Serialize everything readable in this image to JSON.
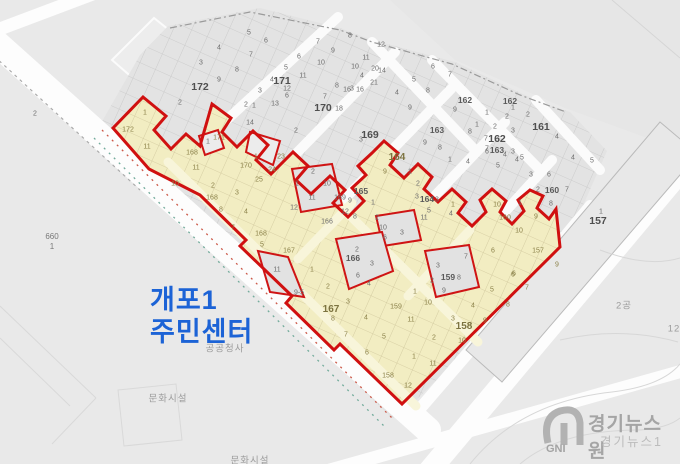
{
  "map": {
    "region_title": {
      "line1": "개포1",
      "line2": "주민센터"
    },
    "colors": {
      "background": "#e9e9e9",
      "parcel_gray": "#e4e4e4",
      "highlight_fill": "#f2edc2",
      "highlight_street": "#f7f3d6",
      "boundary_red": "#d01010",
      "title_blue": "#1c63d6",
      "road_white": "#fdfdfd"
    },
    "labels": [
      [
        "5",
        249,
        33,
        "n"
      ],
      [
        "4",
        219,
        48,
        "n"
      ],
      [
        "3",
        201,
        63,
        "n"
      ],
      [
        "7",
        251,
        55,
        "n"
      ],
      [
        "6",
        266,
        41,
        "n"
      ],
      [
        "8",
        237,
        70,
        "n"
      ],
      [
        "9",
        219,
        80,
        "n"
      ],
      [
        "172",
        200,
        87,
        "b"
      ],
      [
        "2",
        180,
        103,
        "n"
      ],
      [
        "2",
        35,
        114,
        "n"
      ],
      [
        "8",
        350,
        36,
        "n"
      ],
      [
        "7",
        318,
        42,
        "n"
      ],
      [
        "6",
        299,
        57,
        "n"
      ],
      [
        "5",
        286,
        68,
        "n"
      ],
      [
        "9",
        333,
        51,
        "n"
      ],
      [
        "10",
        321,
        63,
        "n"
      ],
      [
        "11",
        303,
        76,
        "n"
      ],
      [
        "4",
        272,
        80,
        "n"
      ],
      [
        "171",
        282,
        81,
        "b"
      ],
      [
        "12",
        287,
        89,
        "n"
      ],
      [
        "3",
        260,
        91,
        "n"
      ],
      [
        "13",
        275,
        104,
        "n"
      ],
      [
        "2",
        246,
        105,
        "n"
      ],
      [
        "1",
        254,
        106,
        "n"
      ],
      [
        "14",
        250,
        123,
        "n"
      ],
      [
        "2",
        296,
        131,
        "n"
      ],
      [
        "12",
        381,
        45,
        "n"
      ],
      [
        "11",
        366,
        58,
        "n"
      ],
      [
        "10",
        355,
        67,
        "n"
      ],
      [
        "14",
        382,
        71,
        "n"
      ],
      [
        "8",
        337,
        86,
        "n"
      ],
      [
        "16",
        360,
        90,
        "n"
      ],
      [
        "7",
        325,
        97,
        "n"
      ],
      [
        "170",
        323,
        108,
        "b"
      ],
      [
        "18",
        339,
        109,
        "n"
      ],
      [
        "4",
        362,
        76,
        "n"
      ],
      [
        "3",
        352,
        89,
        "n"
      ],
      [
        "20",
        375,
        69,
        "n"
      ],
      [
        "21",
        374,
        83,
        "n"
      ],
      [
        "6",
        287,
        96,
        "n"
      ],
      [
        "169",
        370,
        135,
        "b"
      ],
      [
        "3",
        361,
        140,
        "n"
      ],
      [
        "16",
        347,
        90,
        "n"
      ],
      [
        "4",
        397,
        93,
        "n"
      ],
      [
        "8",
        428,
        91,
        "n"
      ],
      [
        "9",
        410,
        108,
        "n"
      ],
      [
        "6",
        433,
        67,
        "n"
      ],
      [
        "7",
        450,
        75,
        "n"
      ],
      [
        "5",
        414,
        80,
        "n"
      ],
      [
        "172",
        128,
        130,
        "y"
      ],
      [
        "1",
        145,
        113,
        "y"
      ],
      [
        "11",
        147,
        147,
        "y"
      ],
      [
        "11",
        196,
        168,
        "y"
      ],
      [
        "1",
        208,
        142,
        "n"
      ],
      [
        "168",
        192,
        153,
        "y"
      ],
      [
        "171",
        219,
        138,
        "y"
      ],
      [
        "10",
        175,
        184,
        "y"
      ],
      [
        "2",
        213,
        186,
        "y"
      ],
      [
        "168",
        212,
        198,
        "y"
      ],
      [
        "3",
        237,
        193,
        "y"
      ],
      [
        "8",
        221,
        210,
        "y"
      ],
      [
        "4",
        246,
        212,
        "y"
      ],
      [
        "7",
        233,
        228,
        "y"
      ],
      [
        "168",
        261,
        234,
        "y"
      ],
      [
        "5",
        262,
        245,
        "y"
      ],
      [
        "1",
        256,
        157,
        "y"
      ],
      [
        "23",
        281,
        157,
        "y"
      ],
      [
        "170",
        246,
        166,
        "y"
      ],
      [
        "24",
        272,
        170,
        "y"
      ],
      [
        "25",
        259,
        180,
        "y"
      ],
      [
        "2",
        313,
        172,
        "n"
      ],
      [
        "1",
        297,
        184,
        "n"
      ],
      [
        "10",
        327,
        184,
        "n"
      ],
      [
        "11",
        312,
        198,
        "n"
      ],
      [
        "12",
        294,
        208,
        "n"
      ],
      [
        "169",
        340,
        198,
        "n"
      ],
      [
        "166",
        327,
        222,
        "n"
      ],
      [
        "12",
        345,
        212,
        "n"
      ],
      [
        "11",
        424,
        218,
        "n"
      ],
      [
        "165",
        361,
        191,
        "s"
      ],
      [
        "9",
        350,
        201,
        "n"
      ],
      [
        "1",
        373,
        203,
        "n"
      ],
      [
        "8",
        355,
        217,
        "n"
      ],
      [
        "2",
        377,
        218,
        "n"
      ],
      [
        "10",
        383,
        228,
        "n"
      ],
      [
        "3",
        402,
        233,
        "n"
      ],
      [
        "6",
        385,
        238,
        "n"
      ],
      [
        "166",
        353,
        258,
        "s"
      ],
      [
        "2",
        357,
        250,
        "n"
      ],
      [
        "3",
        372,
        264,
        "n"
      ],
      [
        "6",
        358,
        276,
        "n"
      ],
      [
        "4",
        369,
        284,
        "n"
      ],
      [
        "164",
        397,
        158,
        "Y"
      ],
      [
        "9",
        385,
        172,
        "y"
      ],
      [
        "1",
        410,
        172,
        "n"
      ],
      [
        "2",
        418,
        184,
        "n"
      ],
      [
        "3",
        417,
        197,
        "n"
      ],
      [
        "164",
        427,
        199,
        "s"
      ],
      [
        "3",
        437,
        200,
        "n"
      ],
      [
        "5",
        429,
        211,
        "n"
      ],
      [
        "4",
        451,
        214,
        "n"
      ],
      [
        "159",
        448,
        277,
        "s"
      ],
      [
        "8",
        459,
        278,
        "n"
      ],
      [
        "3",
        438,
        266,
        "n"
      ],
      [
        "2",
        432,
        281,
        "n"
      ],
      [
        "9",
        444,
        291,
        "n"
      ],
      [
        "7",
        466,
        257,
        "n"
      ],
      [
        "163",
        437,
        130,
        "s"
      ],
      [
        "9",
        425,
        143,
        "n"
      ],
      [
        "8",
        440,
        148,
        "n"
      ],
      [
        "1",
        450,
        160,
        "n"
      ],
      [
        "9",
        455,
        110,
        "n"
      ],
      [
        "7",
        487,
        149,
        "n"
      ],
      [
        "163",
        497,
        150,
        "s"
      ],
      [
        "3",
        513,
        152,
        "n"
      ],
      [
        "4",
        468,
        162,
        "n"
      ],
      [
        "5",
        498,
        166,
        "n"
      ],
      [
        "162",
        465,
        100,
        "s"
      ],
      [
        "162",
        510,
        101,
        "s"
      ],
      [
        "7",
        486,
        139,
        "n"
      ],
      [
        "162",
        497,
        139,
        "b"
      ],
      [
        "1",
        487,
        113,
        "n"
      ],
      [
        "2",
        507,
        117,
        "n"
      ],
      [
        "8",
        470,
        132,
        "n"
      ],
      [
        "2",
        495,
        127,
        "n"
      ],
      [
        "3",
        513,
        131,
        "n"
      ],
      [
        "1",
        477,
        125,
        "n"
      ],
      [
        "6",
        487,
        152,
        "n"
      ],
      [
        "4",
        505,
        155,
        "n"
      ],
      [
        "5",
        522,
        158,
        "n"
      ],
      [
        "161",
        541,
        127,
        "b"
      ],
      [
        "1",
        513,
        108,
        "n"
      ],
      [
        "2",
        528,
        115,
        "n"
      ],
      [
        "4",
        557,
        137,
        "n"
      ],
      [
        "2",
        538,
        190,
        "n"
      ],
      [
        "160",
        552,
        190,
        "s"
      ],
      [
        "7",
        567,
        190,
        "n"
      ],
      [
        "1",
        520,
        203,
        "n"
      ],
      [
        "8",
        551,
        204,
        "n"
      ],
      [
        "3",
        531,
        175,
        "n"
      ],
      [
        "6",
        549,
        175,
        "n"
      ],
      [
        "4",
        517,
        160,
        "n"
      ],
      [
        "4",
        573,
        158,
        "n"
      ],
      [
        "5",
        592,
        161,
        "n"
      ],
      [
        "1",
        453,
        205,
        "y"
      ],
      [
        "10",
        497,
        205,
        "y"
      ],
      [
        "160",
        505,
        218,
        "y"
      ],
      [
        "9",
        536,
        217,
        "y"
      ],
      [
        "10",
        519,
        231,
        "y"
      ],
      [
        "6",
        493,
        251,
        "y"
      ],
      [
        "157",
        538,
        251,
        "y"
      ],
      [
        "9",
        557,
        265,
        "y"
      ],
      [
        "6",
        514,
        274,
        "y"
      ],
      [
        "1",
        601,
        212,
        "n"
      ],
      [
        "157",
        598,
        221,
        "b"
      ],
      [
        "11",
        277,
        270,
        "n"
      ],
      [
        "9-5",
        299,
        293,
        "n"
      ],
      [
        "167",
        289,
        251,
        "y"
      ],
      [
        "1",
        312,
        270,
        "y"
      ],
      [
        "2",
        328,
        287,
        "y"
      ],
      [
        "3",
        348,
        302,
        "y"
      ],
      [
        "167",
        331,
        310,
        "Y"
      ],
      [
        "8",
        333,
        319,
        "y"
      ],
      [
        "7",
        346,
        335,
        "y"
      ],
      [
        "4",
        366,
        318,
        "y"
      ],
      [
        "5",
        384,
        337,
        "y"
      ],
      [
        "6",
        367,
        353,
        "y"
      ],
      [
        "159",
        396,
        307,
        "y"
      ],
      [
        "1",
        415,
        292,
        "y"
      ],
      [
        "10",
        428,
        303,
        "y"
      ],
      [
        "11",
        411,
        320,
        "y"
      ],
      [
        "3",
        453,
        319,
        "y"
      ],
      [
        "158",
        464,
        327,
        "Y"
      ],
      [
        "9",
        485,
        321,
        "y"
      ],
      [
        "2",
        434,
        338,
        "y"
      ],
      [
        "10",
        462,
        341,
        "y"
      ],
      [
        "5",
        492,
        290,
        "y"
      ],
      [
        "6",
        513,
        275,
        "y"
      ],
      [
        "7",
        527,
        288,
        "y"
      ],
      [
        "8",
        508,
        305,
        "y"
      ],
      [
        "4",
        473,
        306,
        "y"
      ],
      [
        "1",
        414,
        357,
        "y"
      ],
      [
        "11",
        433,
        364,
        "y"
      ],
      [
        "158",
        388,
        376,
        "y"
      ],
      [
        "12",
        408,
        386,
        "y"
      ],
      [
        "660",
        52,
        237,
        "g"
      ],
      [
        "1",
        52,
        247,
        "g"
      ],
      [
        "공공청사",
        225,
        349,
        "k"
      ],
      [
        "문화시설",
        168,
        399,
        "k"
      ],
      [
        "문화시설",
        250,
        461,
        "k"
      ],
      [
        "2공",
        624,
        306,
        "k"
      ],
      [
        "12",
        674,
        329,
        "k"
      ]
    ]
  },
  "watermark": {
    "brand": "경기뉴스원",
    "sub": "경기뉴스1",
    "logo": "GNI"
  }
}
